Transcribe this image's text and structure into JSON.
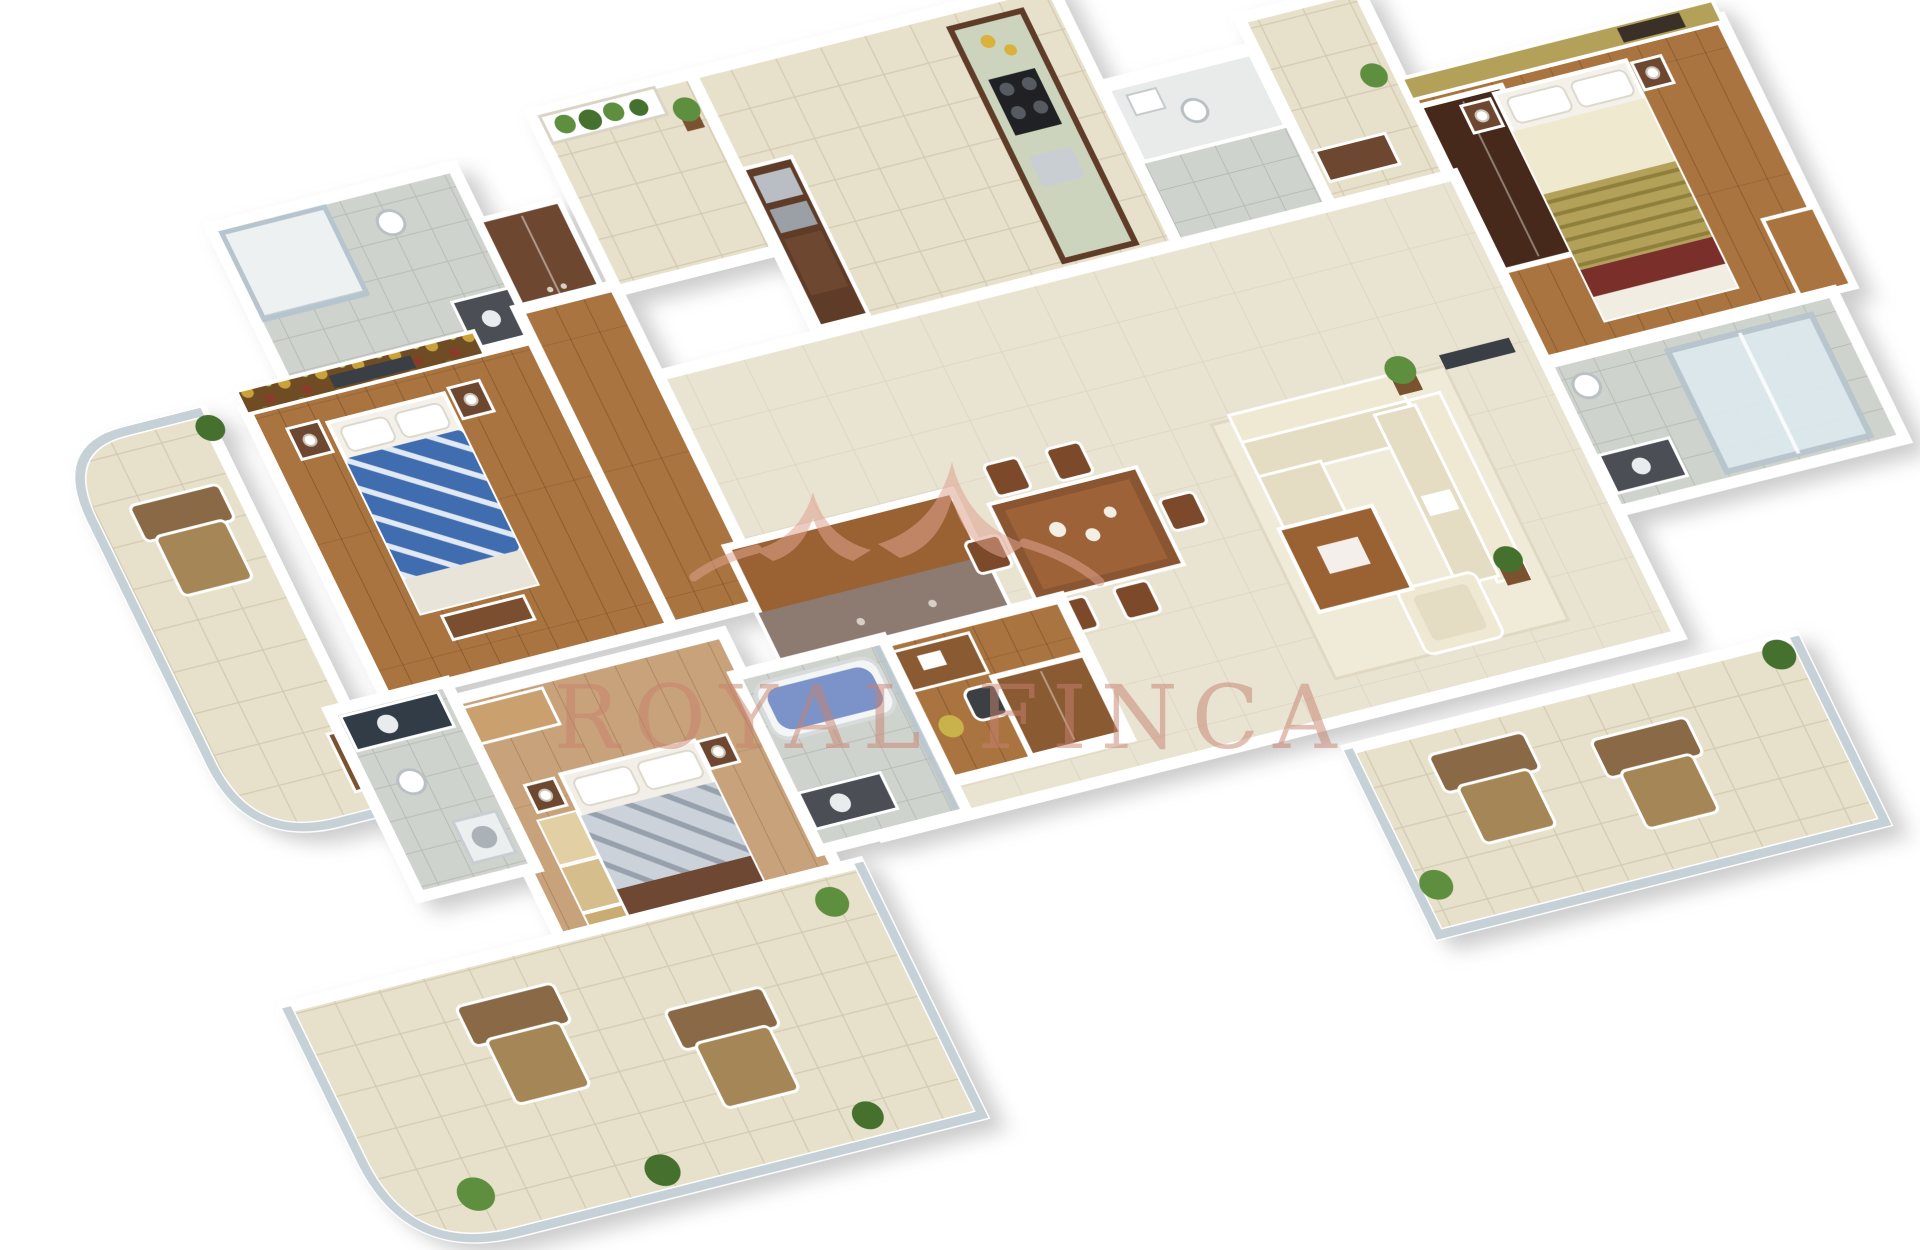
{
  "watermark": {
    "text": "ROYAL FINCA",
    "logo": "crown-swoosh-logo",
    "color": "#c8826f",
    "logo_color": "#dfa28f"
  },
  "palette": {
    "background": "#ffffff",
    "wall": "#ffffff",
    "wallShade": "#c9ced6",
    "woodDark": "#6e4731",
    "woodMid": "#a9743f",
    "woodPlank": "#c8a27a",
    "tileBeige": "#e7e0cb",
    "grout": "#d2cab0",
    "tileGray": "#cfd3cd",
    "groutGray": "#b7bcb5",
    "sage": "#cdd4bd",
    "navy": "#2e3f58",
    "blueBed": "#3f6db0",
    "blueTub": "#7b93c8",
    "cream": "#efe9d4",
    "cream2": "#e4ddc3",
    "olive": "#b3a159",
    "maroon": "#7a2f2a",
    "glass": "#b6c4cd",
    "plant": "#5d8f3e",
    "plantDark": "#46702e",
    "taupe": "#8d7a70",
    "brown": "#9a6233",
    "charcoal": "#3a3f46",
    "lounge": "#8a6a46",
    "loungeSeat": "#a58656",
    "mosaicBase": "#6f4c24",
    "floorBeige": "#e9e3d2"
  },
  "scene": {
    "type": "3d-floor-plan-render",
    "view": "isometric",
    "elements": [
      "left-curved-balcony",
      "bathroom-1",
      "wardrobe-closet-1",
      "bedroom-1-blue-bed",
      "entry-foyer",
      "kitchen-island-counter",
      "breakfast-bar",
      "utility-bathroom",
      "appliance-unit",
      "passage-console",
      "bedroom-2-olive-wall",
      "bathroom-2-shower",
      "living-room-cream-sofas",
      "dining-table-six-chairs",
      "sideboard-counter",
      "study-desk-wardrobe",
      "master-bedroom-wood-bed",
      "master-bathroom-blue-tub",
      "powder-room",
      "bottom-left-terrace",
      "bottom-right-terrace",
      "lounge-chairs",
      "potted-plants",
      "glass-railings"
    ]
  }
}
